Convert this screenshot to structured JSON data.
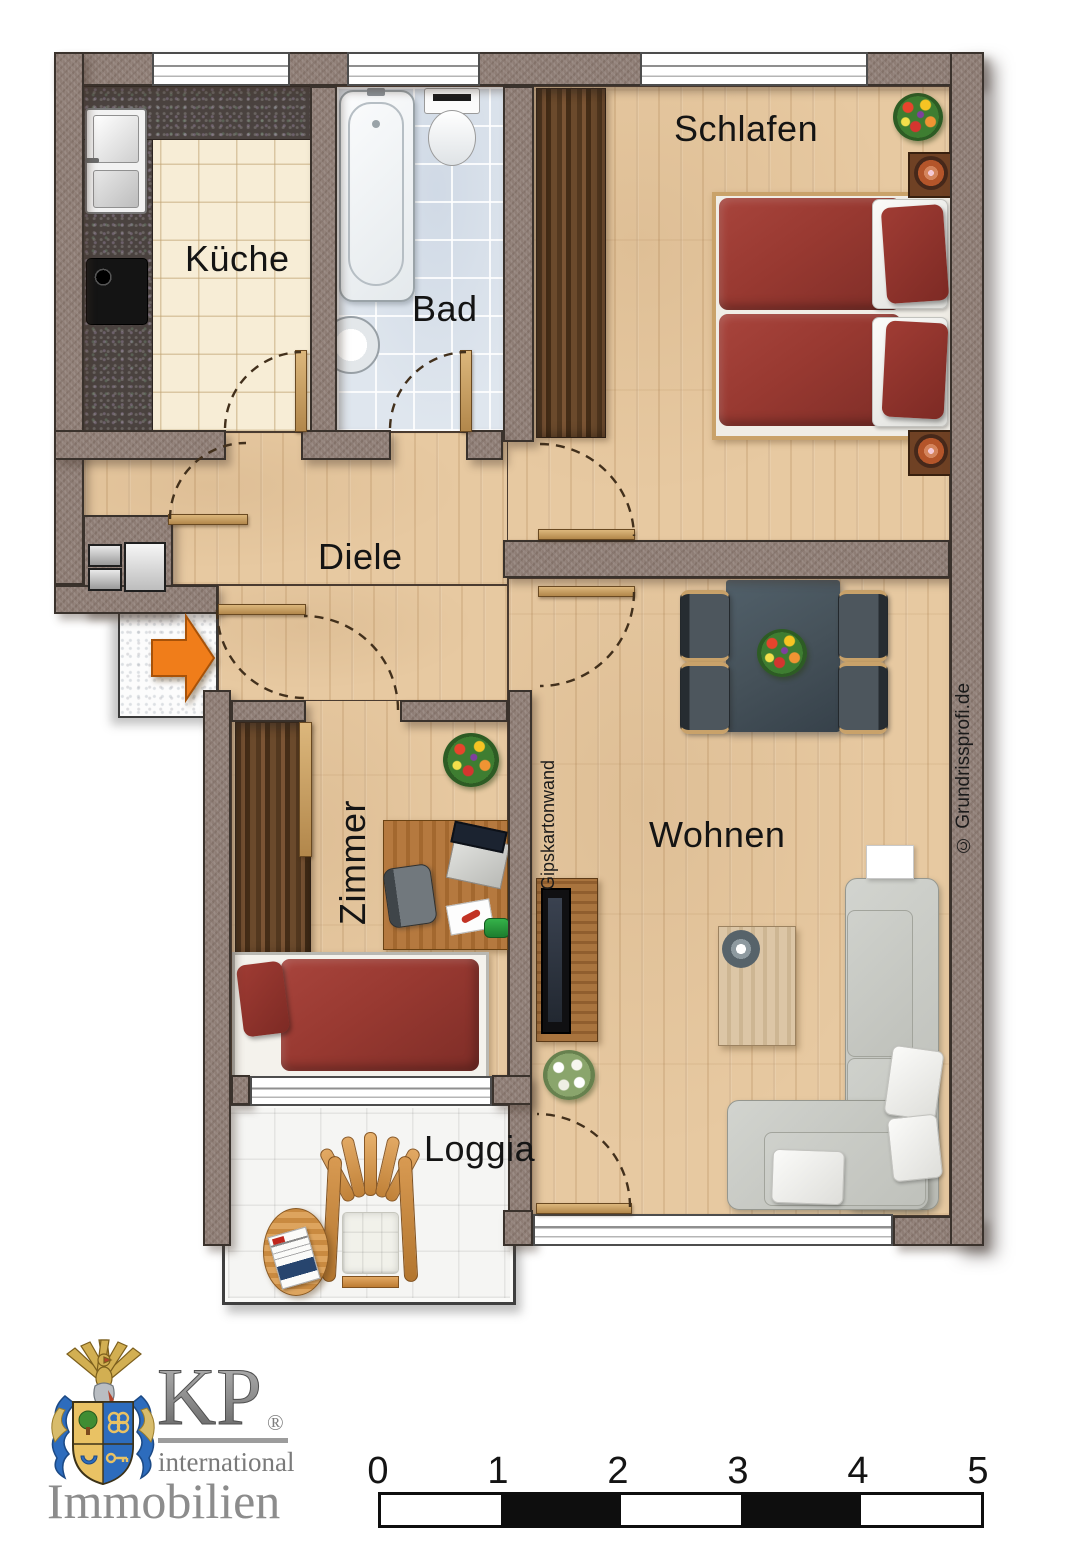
{
  "document": {
    "type": "apartment floor plan"
  },
  "rooms": {
    "kueche": {
      "label": "Küche"
    },
    "bad": {
      "label": "Bad"
    },
    "schlafen": {
      "label": "Schlafen"
    },
    "diele": {
      "label": "Diele"
    },
    "zimmer": {
      "label": "Zimmer"
    },
    "wohnen": {
      "label": "Wohnen"
    },
    "loggia": {
      "label": "Loggia"
    }
  },
  "annotations": {
    "partition_wall": "Gipskartonwand",
    "watermark": "© Grundrissprofi.de"
  },
  "logo": {
    "monogram": "KP",
    "registered": "®",
    "tagline": "international",
    "company": "Immobilien"
  },
  "scalebar": {
    "unit_labels": [
      "0",
      "1",
      "2",
      "3",
      "4",
      "5"
    ]
  },
  "icons": {
    "entrance-arrow": "orange right-pointing entry arrow"
  },
  "colors": {
    "wall": "#8E7D75",
    "wood_floor": "#E7C9A1",
    "kitchen_tile": "#F7EDD6",
    "bath_tile": "#DFE6EE",
    "loggia_tile": "#F5F5F3",
    "bed_red": "#9C3A33",
    "sofa_gray": "#C9CBC6",
    "dining_table": "#46525A",
    "door_wood": "#C9A266",
    "accent_arrow": "#F07D1A"
  }
}
